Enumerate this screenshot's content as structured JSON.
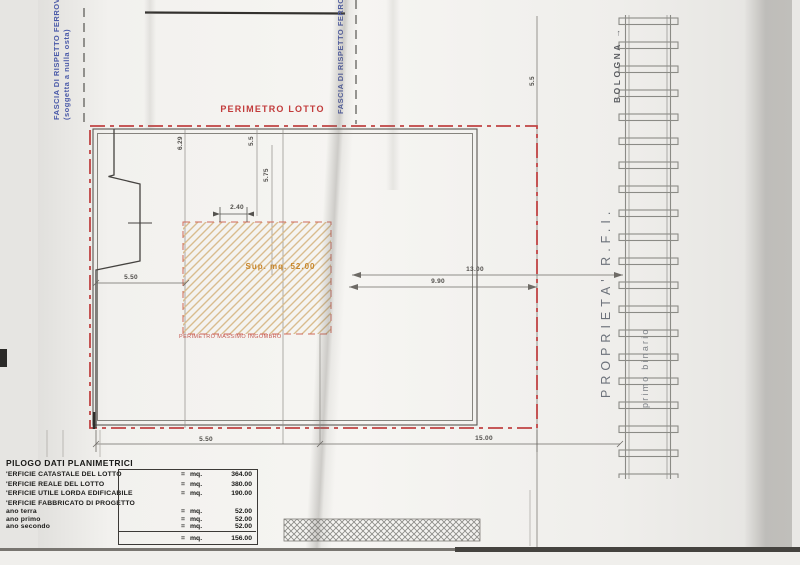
{
  "labels": {
    "fascia_left_line1": "FASCIA DI RISPETTO FERROVIA",
    "fascia_left_line2": "(soggetta a nulla osta)",
    "fascia_mid": "FASCIA DI RISPETTO FERROVIA",
    "perimetro_lotto": "PERIMETRO LOTTO",
    "perimetro_massimo_ingombro": "PERIMETRO MASSIMO INGOMBRO",
    "sup_fabbricato": "Sup. mq. 52.00"
  },
  "railway": {
    "bologna": "BOLOGNA →",
    "proprieta": "PROPRIETA'  R.F.I.",
    "primo_binario": "primo binario"
  },
  "dimensions": {
    "d_2_40": "2.40",
    "d_13_00": "13.00",
    "d_9_90": "9.90",
    "d_5_50_left": "5.50",
    "d_5_50_bottom": "5.50",
    "d_15_00": "15.00",
    "d_6_29": "6.29",
    "d_5_75": "5.75",
    "d_5_50_v1": "5.5",
    "d_5_50_v2": "5.5"
  },
  "table": {
    "title": "PILOGO DATI PLANIMETRICI",
    "rows": [
      {
        "label": "'ERFICIE CATASTALE DEL LOTTO",
        "eq": "=",
        "unit": "mq.",
        "value": "364.00"
      },
      {
        "label": "'ERFICIE REALE DEL LOTTO",
        "eq": "=",
        "unit": "mq.",
        "value": "380.00"
      },
      {
        "label": "'ERFICIE UTILE LORDA EDIFICABILE",
        "eq": "=",
        "unit": "mq.",
        "value": "190.00"
      },
      {
        "label": "'ERFICIE FABBRICATO DI PROGETTO",
        "eq": "",
        "unit": "",
        "value": ""
      },
      {
        "label": "ano terra",
        "eq": "=",
        "unit": "mq.",
        "value": "52.00"
      },
      {
        "label": "ano primo",
        "eq": "=",
        "unit": "mq.",
        "value": "52.00"
      },
      {
        "label": "ano secondo",
        "eq": "=",
        "unit": "mq.",
        "value": "52.00"
      },
      {
        "label": "",
        "eq": "=",
        "unit": "mq.",
        "value": "156.00"
      }
    ]
  },
  "colors": {
    "perimeter_red": "#c04343",
    "fascia_blue": "#4a5aa8",
    "project_orange": "#c8862a",
    "hatch_tan": "#d9bc8e",
    "line_gray": "#6e6b66"
  }
}
